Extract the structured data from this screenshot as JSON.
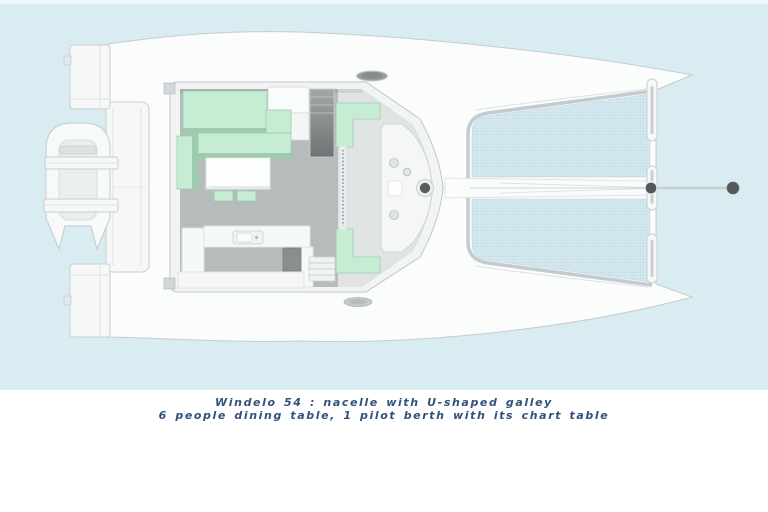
{
  "caption": {
    "line1": "Windelo 54 : nacelle with U-shaped galley",
    "line2": "6 people dining table, 1 pilot berth with its chart table"
  },
  "colors": {
    "bg-blue": "#d8ecf2",
    "bg-white": "#ffffff",
    "hull-white": "#fbfcfc",
    "hull-outline": "#c6cccf",
    "mesh-blue": "#d5e9f0",
    "mesh-grid": "#bdd5de",
    "mint": "#c6edd4",
    "mint-dark": "#9ecbad",
    "floor-gray": "#b6bbbc",
    "cockpit-gray": "#dfe3e4",
    "dark-fitting": "#54585b",
    "caption-navy": "#33507d"
  },
  "illustration": {
    "type": "catamaran-floorplan-top-view",
    "boat_model": "Windelo 54",
    "labeled_features": [
      "nacelle",
      "u-shaped-galley",
      "6-people-dining-table",
      "pilot-berth",
      "chart-table"
    ],
    "visible_parts": [
      "port-hull",
      "starboard-hull",
      "stern-platform",
      "dinghy-on-davits",
      "galley-sink",
      "cockpit-benches",
      "companionway-steps",
      "helm-console",
      "mast-step",
      "trampoline-net",
      "forward-crossbeam",
      "bowsprit-forestay",
      "deck-hatches"
    ]
  }
}
